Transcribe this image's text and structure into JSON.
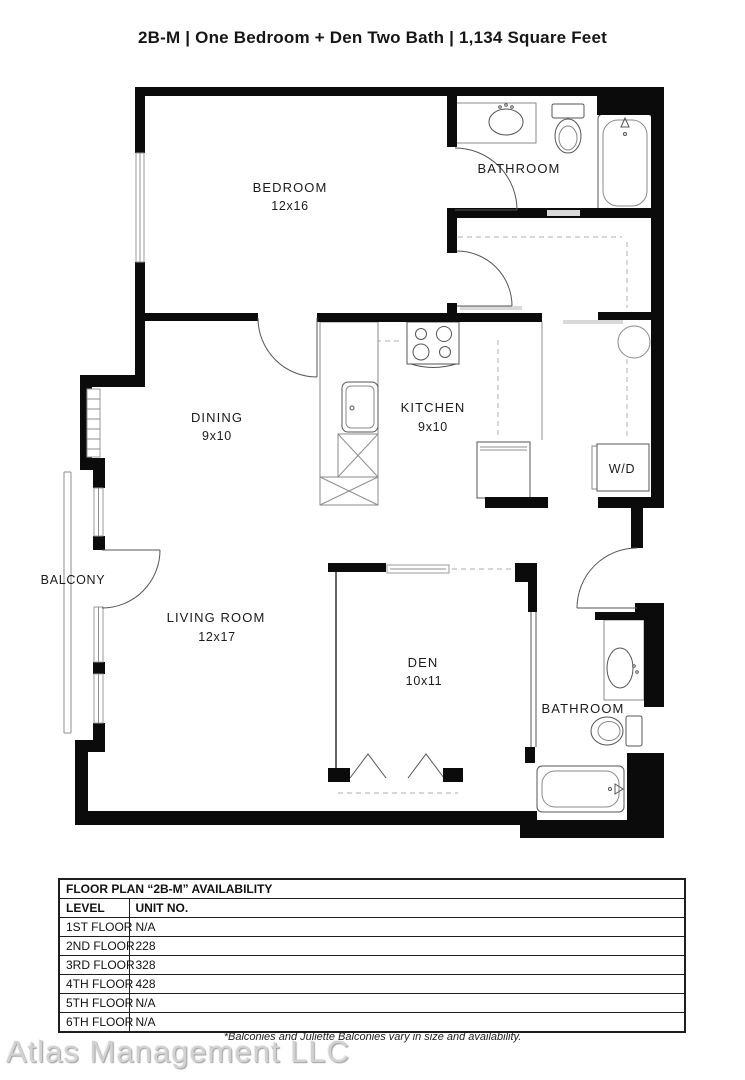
{
  "title": "2B-M | One Bedroom + Den Two Bath | 1,134  Square Feet",
  "floor_plan": {
    "rooms": {
      "bedroom": {
        "name": "BEDROOM",
        "dims": "12x16"
      },
      "bathroom_top": {
        "name": "BATHROOM"
      },
      "dining": {
        "name": "DINING",
        "dims": "9x10"
      },
      "kitchen": {
        "name": "KITCHEN",
        "dims": "9x10"
      },
      "laundry": {
        "name": "W/D"
      },
      "balcony": {
        "name": "BALCONY"
      },
      "living_room": {
        "name": "LIVING ROOM",
        "dims": "12x17"
      },
      "den": {
        "name": "DEN",
        "dims": "10x11"
      },
      "bathroom_bottom": {
        "name": "BATHROOM"
      }
    }
  },
  "availability_table": {
    "title": "FLOOR PLAN “2B-M” AVAILABILITY",
    "columns": [
      "LEVEL",
      "UNIT NO."
    ],
    "rows": [
      {
        "level": "1ST FLOOR",
        "unit": "N/A"
      },
      {
        "level": "2ND FLOOR",
        "unit": "228"
      },
      {
        "level": "3RD FLOOR",
        "unit": "328"
      },
      {
        "level": "4TH FLOOR",
        "unit": "428"
      },
      {
        "level": "5TH FLOOR",
        "unit": "N/A"
      },
      {
        "level": "6TH FLOOR",
        "unit": "N/A"
      }
    ]
  },
  "footnote": "*Balconies and Juliette Balconies vary in size and availability.",
  "watermark": "Atlas Management LLC"
}
